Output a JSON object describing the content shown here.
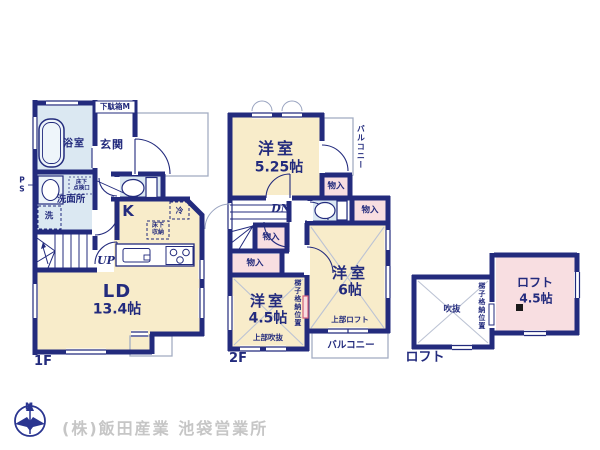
{
  "floor1": {
    "floor_label": "1F",
    "bath": "浴室",
    "entrance": "玄関",
    "shoe_cabinet": "下駄箱M",
    "pipe_space": "P\nS",
    "inspection_hatch": "床下\n点検口",
    "washroom": "洗面所",
    "laundry": "洗",
    "kitchen": "K",
    "fridge": "冷",
    "underfloor_storage": "床下\n収納",
    "stairs_up": "UP",
    "living_dining": "LD",
    "living_dining_size": "13.4帖"
  },
  "floor2": {
    "floor_label": "2F",
    "room_525": "洋室",
    "room_525_size": "5.25帖",
    "balcony_right": "バルコニー",
    "closet": "物入",
    "stairs_down": "DN",
    "room_45": "洋室",
    "room_45_size": "4.5帖",
    "above_void": "上部吹抜",
    "ladder_position": "梯子格納位置",
    "room_6": "洋室",
    "room_6_size": "6帖",
    "above_loft": "上部ロフト",
    "balcony_bottom": "バルコニー"
  },
  "loft": {
    "floor_label": "ロフト",
    "void": "吹抜",
    "ladder_position": "梯子格納位置",
    "name": "ロフト",
    "size": "4.5帖"
  },
  "compass": {
    "north": "N"
  },
  "footer": {
    "company": "(株)飯田産業 池袋営業所"
  },
  "colors": {
    "wall_navy": "#232b7d",
    "room_cream": "#f8ecca",
    "room_blue": "#dbe8f2",
    "room_pink": "#f8dee1",
    "thin_line_gray": "#a3adc2",
    "footer_gray": "#c6c6c6"
  }
}
